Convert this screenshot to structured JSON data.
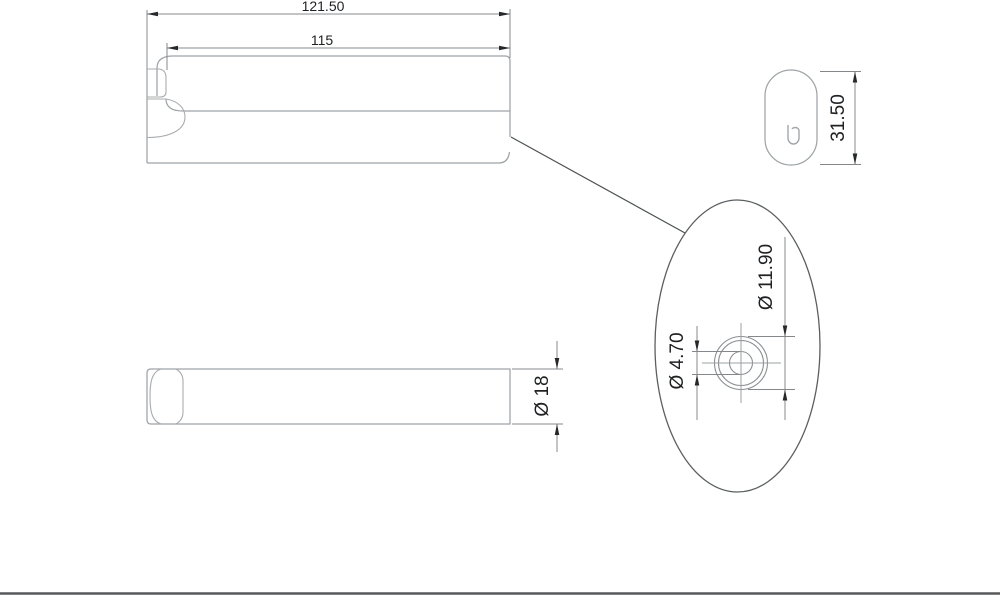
{
  "drawing": {
    "type": "technical-dimension-drawing",
    "part": "wall hook arm with mounting hole detail",
    "dimensions": {
      "overall_length": "121.50",
      "arm_length": "115",
      "end_view_height": "31.50",
      "bar_thickness": "Ø 18",
      "hole_outer_diameter": "Ø 11.90",
      "hole_inner_diameter": "Ø 4.70"
    },
    "end_view_mark": "b",
    "colors": {
      "background": "#ffffff",
      "part_outline": "#9fa4a6",
      "dimension_lines": "#84888b",
      "dimension_text": "#1f2123",
      "detail_boundary": "#5b5f61",
      "frame_line": "#56585a"
    }
  }
}
